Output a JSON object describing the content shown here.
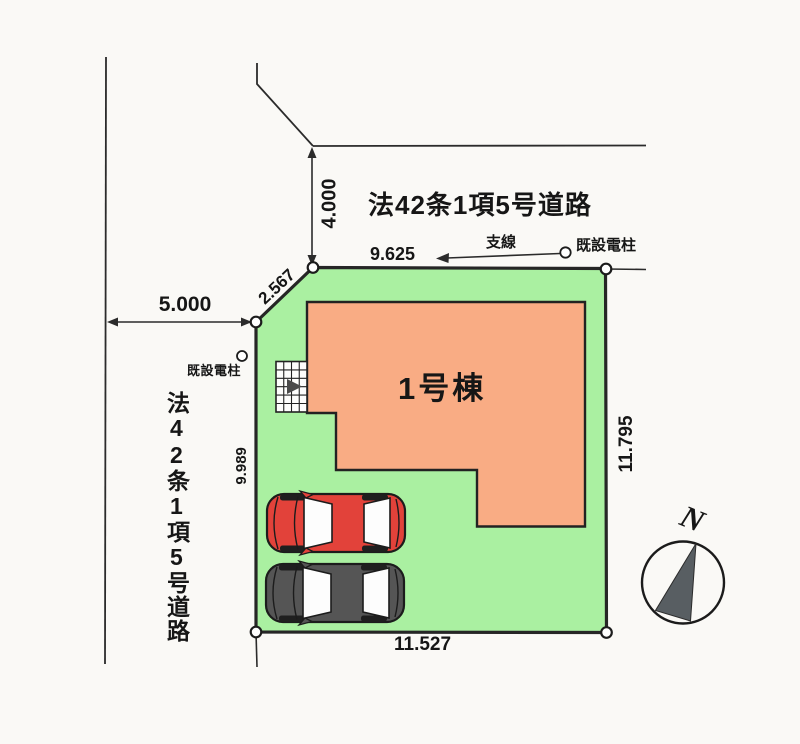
{
  "diagram": {
    "building": {
      "label": "1号棟"
    },
    "roads": {
      "top_label": "法42条1項5号道路",
      "left_label": "法42条1項5号道路"
    },
    "dimensions": {
      "road_width_top": "4.000",
      "road_width_left": "5.000",
      "chamfer": "2.567",
      "edge_top": "9.625",
      "edge_left": "9.989",
      "edge_right": "11.795",
      "edge_bottom": "11.527"
    },
    "utilities": {
      "guy_wire": "支線",
      "existing_pole_right": "既設電柱",
      "existing_pole_left": "既設電柱"
    },
    "compass": {
      "north": "N"
    }
  },
  "colors": {
    "lot_fill": "#aaf0a1",
    "building_fill": "#f9ac84",
    "line": "#2b2b2b",
    "car_red": "#e2423a",
    "car_dark": "#555555",
    "compass_needle": "#585e62"
  }
}
